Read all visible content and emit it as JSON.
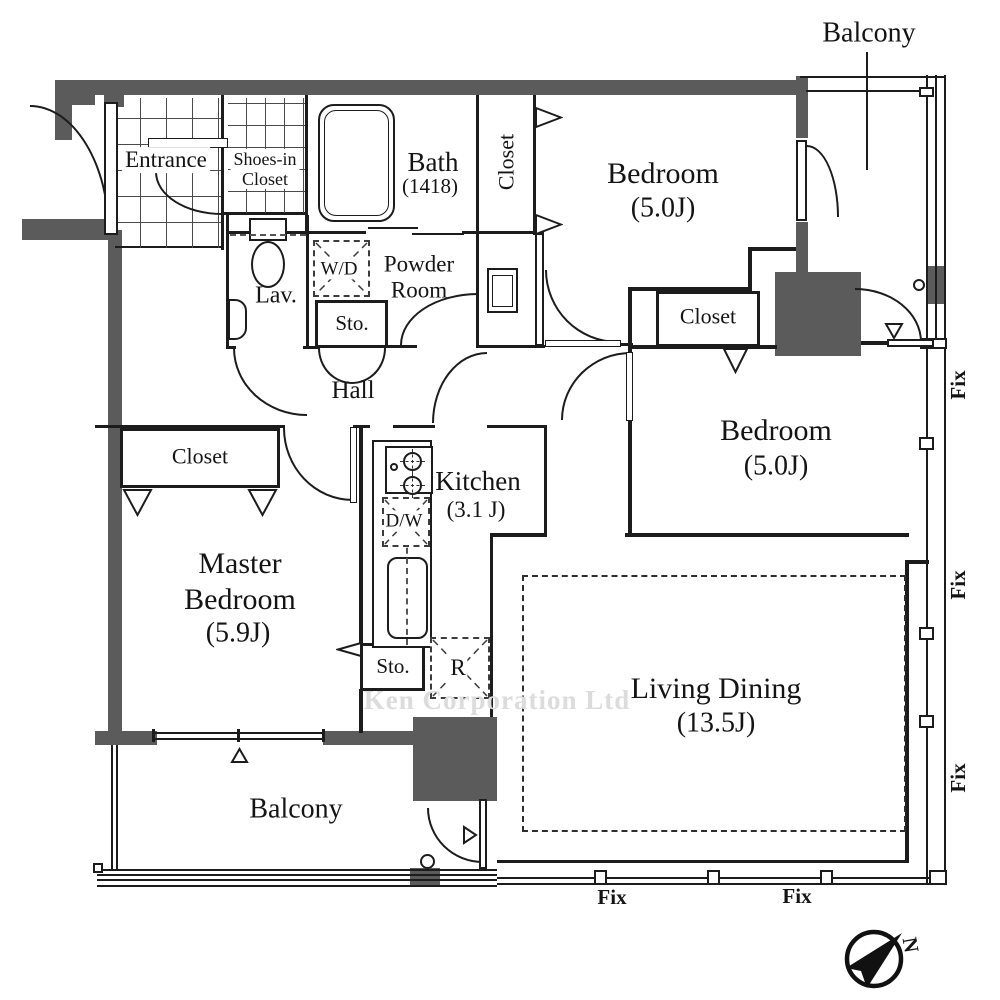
{
  "title": "Apartment floor plan",
  "colors": {
    "wall": "#5b5b5b",
    "line": "#1c1c1c",
    "watermark": "#dcdcdc",
    "background": "#ffffff"
  },
  "watermark": "Ken Corporation Ltd",
  "compass": {
    "north_label": "N"
  },
  "rooms": {
    "entrance": {
      "label": "Entrance"
    },
    "shoes_in_closet": {
      "label": "Shoes-in\nCloset"
    },
    "bath": {
      "label": "Bath",
      "size": "(1418)"
    },
    "closet_bath_side": {
      "label": "Closet"
    },
    "bedroom1": {
      "label": "Bedroom",
      "size": "(5.0J)"
    },
    "lavatory": {
      "label": "Lav."
    },
    "washer_dryer": {
      "label": "W/D"
    },
    "powder_room": {
      "label": "Powder\nRoom"
    },
    "storage_hall": {
      "label": "Sto."
    },
    "hall": {
      "label": "Hall"
    },
    "closet_bedroom2": {
      "label": "Closet"
    },
    "bedroom2": {
      "label": "Bedroom",
      "size": "(5.0J)"
    },
    "closet_master": {
      "label": "Closet"
    },
    "master_bedroom": {
      "label": "Master\nBedroom",
      "size": "(5.9J)"
    },
    "kitchen": {
      "label": "Kitchen",
      "size": "(3.1 J)"
    },
    "dishwasher": {
      "label": "D/W"
    },
    "storage_kitchen": {
      "label": "Sto."
    },
    "refrigerator": {
      "label": "R"
    },
    "living_dining": {
      "label": "Living Dining",
      "size": "(13.5J)"
    },
    "balcony_south": {
      "label": "Balcony"
    },
    "balcony_east": {
      "label": "Balcony"
    }
  },
  "windows": {
    "fix_labels": [
      "Fix",
      "Fix",
      "Fix",
      "Fix",
      "Fix"
    ]
  }
}
